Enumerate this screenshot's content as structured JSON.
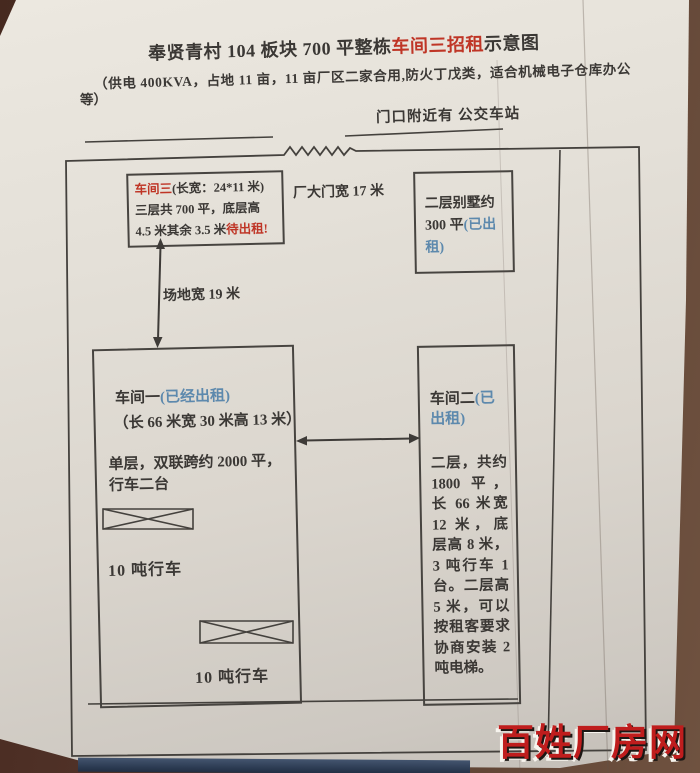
{
  "doc": {
    "title_prefix": "奉贤青村 104 板块 700 平整栋",
    "title_highlight": "车间三招租",
    "title_suffix": "示意图",
    "subtitle_line1": "（供电 400KVA，占地 11 亩，11 亩厂区二家合用,防火丁戊类，适合机械电子仓库办公",
    "subtitle_line2": "等）",
    "bus_note": "门口附近有  公交车站"
  },
  "diagram": {
    "gate_label": "厂大门宽 17 米",
    "yard_label": "场地宽 19 米",
    "workshop3": {
      "name": "车间三",
      "dims": "(长宽：24*11 米)",
      "line2": "三层共 700 平，底层高",
      "line3": "4.5 米其余 3.5 米",
      "status": "待出租!"
    },
    "villa": {
      "text": "二层别墅约 300 平",
      "status": "(已出租)"
    },
    "workshop1": {
      "name": "车间一",
      "status": "(已经出租)",
      "dims": "（长 66 米宽 30 米高 13 米）",
      "desc": "单层，双联跨约 2000 平，行车二台",
      "crane_label": "10 吨行车"
    },
    "workshop2": {
      "name": "车间二",
      "status": "(已出租)",
      "desc": "二层，共约 1800 平，长 66 米宽 12 米，底层高 8 米，3 吨行车 1 台。二层高 5 米，可以按租客要求协商安装 2 吨电梯。"
    }
  },
  "watermark": "百姓厂房网",
  "colors": {
    "ink": "#3b3835",
    "red": "#bf3526",
    "blue": "#5d89ad",
    "paper": "#e3dfd7",
    "watermark_red": "#bf1d1d",
    "table_brown": "#53342a",
    "table_edge_navy": "#2a3950"
  }
}
